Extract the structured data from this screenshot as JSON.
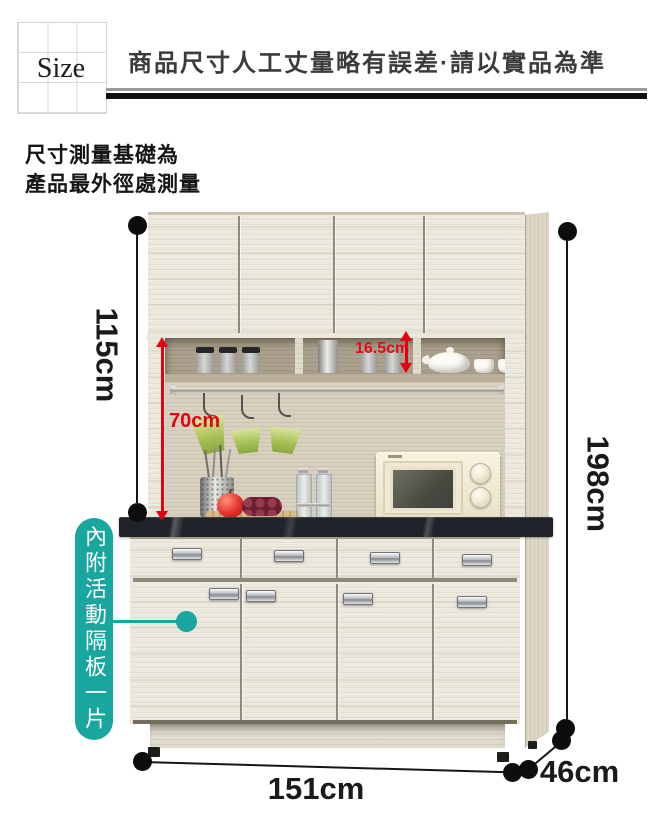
{
  "header": {
    "size_label": "Size",
    "notice": "商品尺寸人工丈量略有誤差·請以實品為準"
  },
  "note": {
    "line1": "尺寸測量基礎為",
    "line2": "產品最外徑處測量"
  },
  "dimensions": {
    "upper_section_height": "115cm",
    "total_height": "198cm",
    "width": "151cm",
    "depth": "46cm",
    "open_area_height": "70cm",
    "niche_height": "16.5cm"
  },
  "callout": {
    "text": "內附活動隔板一片"
  },
  "colors": {
    "accent_teal": "#19a69e",
    "dimension_red": "#e60012",
    "dimension_black": "#161616",
    "wood_light": "#ebe8dd",
    "back_panel": "#d8d1bf",
    "niche_interior": "#aba18e",
    "countertop": "#20242a"
  }
}
